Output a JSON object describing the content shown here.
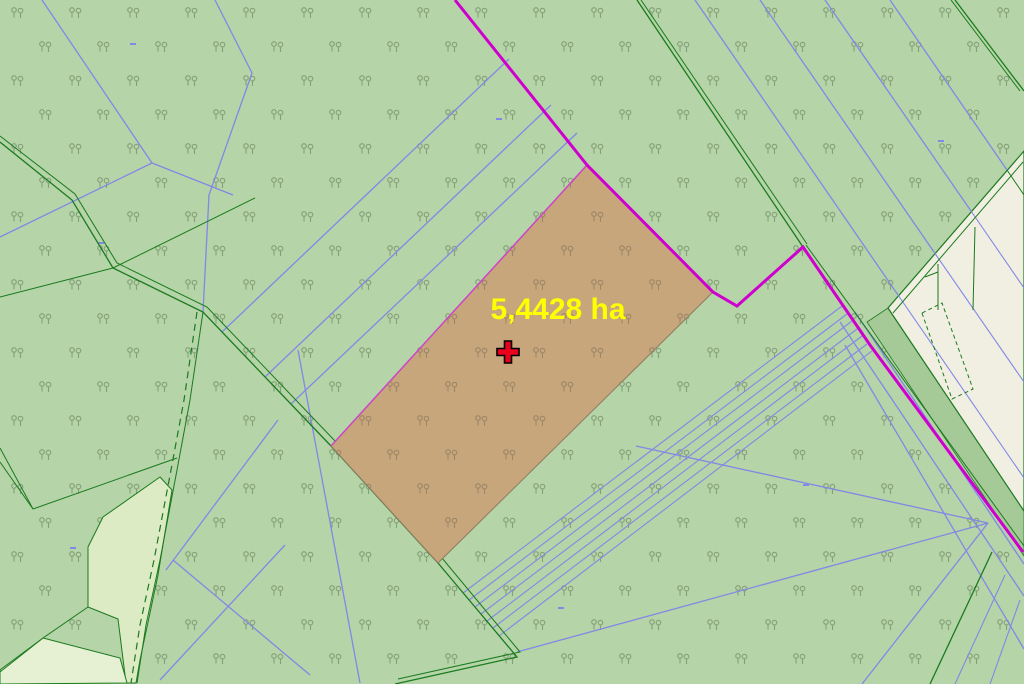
{
  "window": {
    "width": 1024,
    "height": 684
  },
  "map": {
    "selected_parcel": {
      "area_label": "5,4428 ha",
      "marker_icon": "red-cross-marker"
    },
    "symbols": {
      "forest_symbol": "paired-tree-icon"
    }
  },
  "palette": {
    "background-green": "#b5d4a7",
    "field-light": "#dcebc4",
    "field-lighter": "#e6f1d3",
    "built-area-cream": "#f1efe2",
    "band-green": "#a6c998",
    "parcel-fill": "#c7a67c",
    "parcel-outline": "#8d7b60",
    "boundary-blue": "#8288e6",
    "boundary-green": "#1b7a1f",
    "district-magenta": "#cf00cf",
    "parcel-edge-magenta": "#cf44c8",
    "label-yellow": "#ffff00",
    "marker-red": "#e8001c",
    "tree-symbol-green": "#84a078",
    "tree-symbol-brown": "#9c8666"
  }
}
